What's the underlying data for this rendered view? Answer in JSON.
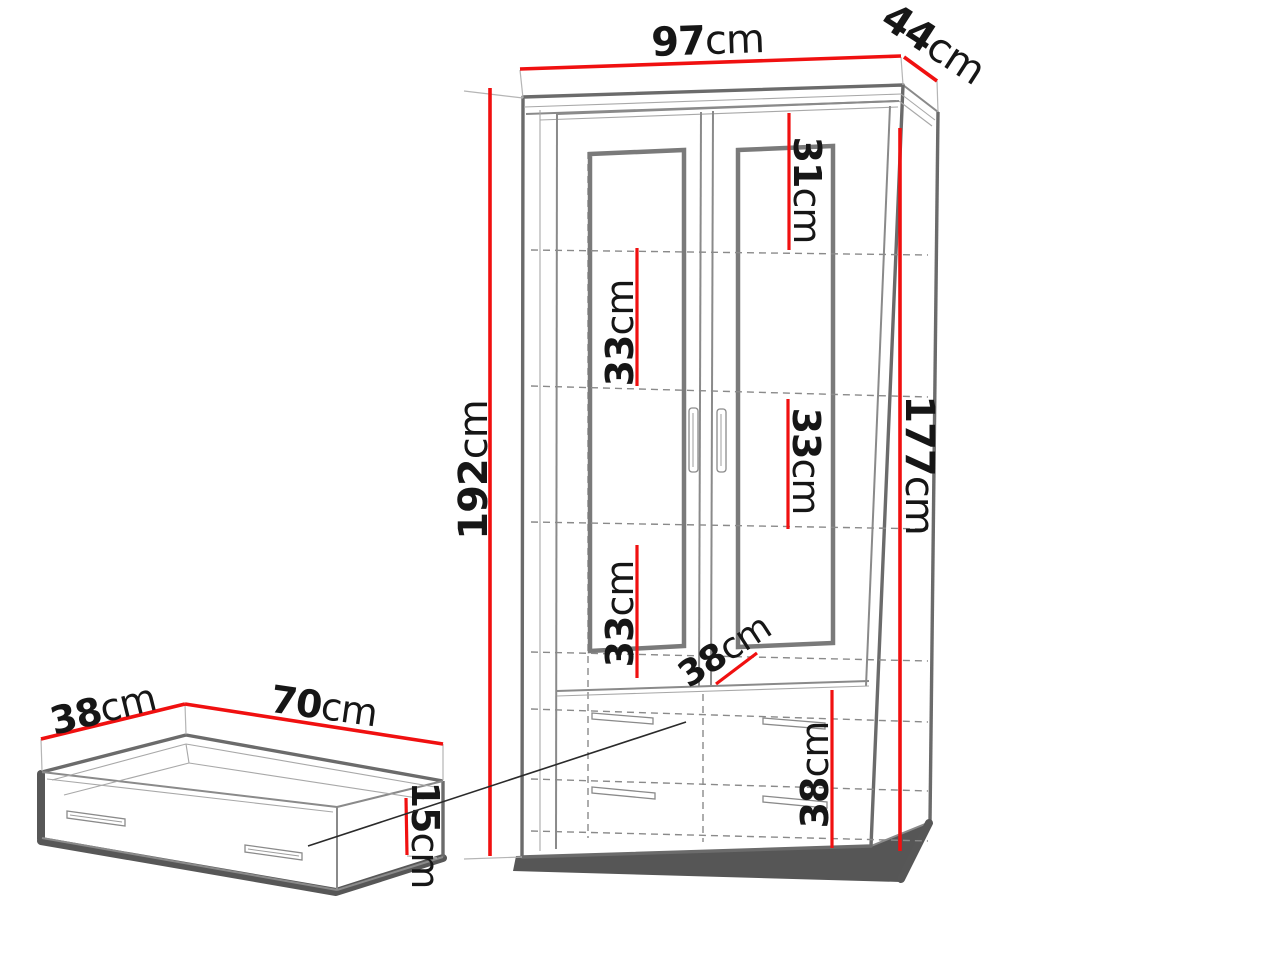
{
  "diagram": {
    "title": "furniture dimension diagram",
    "accent_red": "#f01010",
    "line_gray": "#8a8a8a",
    "background": "#ffffff",
    "cabinet": {
      "name": "two-door display cabinet with drawers",
      "dims": {
        "width": {
          "value": "97",
          "unit": "cm"
        },
        "depth": {
          "value": "44",
          "unit": "cm"
        },
        "height": {
          "value": "192",
          "unit": "cm"
        },
        "interior_height": {
          "value": "177",
          "unit": "cm"
        },
        "top_section": {
          "value": "31",
          "unit": "cm"
        },
        "shelf_section_2": {
          "value": "33",
          "unit": "cm"
        },
        "shelf_section_3": {
          "value": "33",
          "unit": "cm"
        },
        "shelf_section_4": {
          "value": "33",
          "unit": "cm"
        },
        "interior_depth": {
          "value": "38",
          "unit": "cm"
        },
        "drawer_section": {
          "value": "38",
          "unit": "cm"
        }
      }
    },
    "drawer": {
      "name": "pull-out drawer box",
      "dims": {
        "depth": {
          "value": "38",
          "unit": "cm"
        },
        "width": {
          "value": "70",
          "unit": "cm"
        },
        "height": {
          "value": "15",
          "unit": "cm"
        }
      }
    }
  }
}
